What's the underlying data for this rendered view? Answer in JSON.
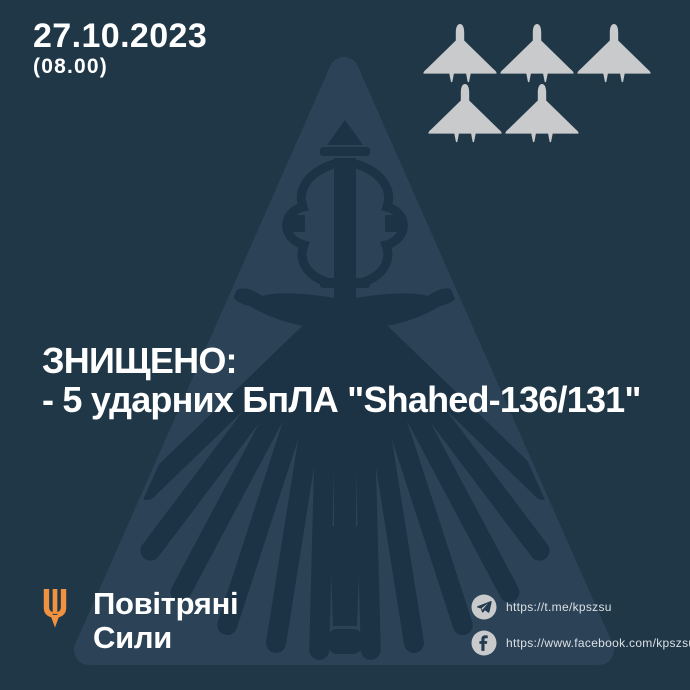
{
  "header": {
    "date": "27.10.2023",
    "time": "(08.00)"
  },
  "tally": {
    "drone_count": 5,
    "drone_icon": "shahed-drone-icon"
  },
  "headline": {
    "line1": "ЗНИЩЕНО:",
    "line2": "- 5 ударних БпЛА \"Shahed-136/131\""
  },
  "footer": {
    "brand": {
      "line1": "Повітряні",
      "line2": "Сили"
    },
    "links": {
      "telegram": "https://t.me/kpszsu",
      "facebook": "https://www.facebook.com/kpszsu"
    }
  },
  "colors": {
    "background": "#1f3747",
    "triangle": "#2c4257",
    "emblem": "#1c3245",
    "drone_fill": "#c8cacc",
    "accent_orange": "#f0923f",
    "text": "#ffffff",
    "muted_text": "#dce0e4",
    "icon_bg": "#c8cacc",
    "icon_glyph": "#243a4e"
  }
}
